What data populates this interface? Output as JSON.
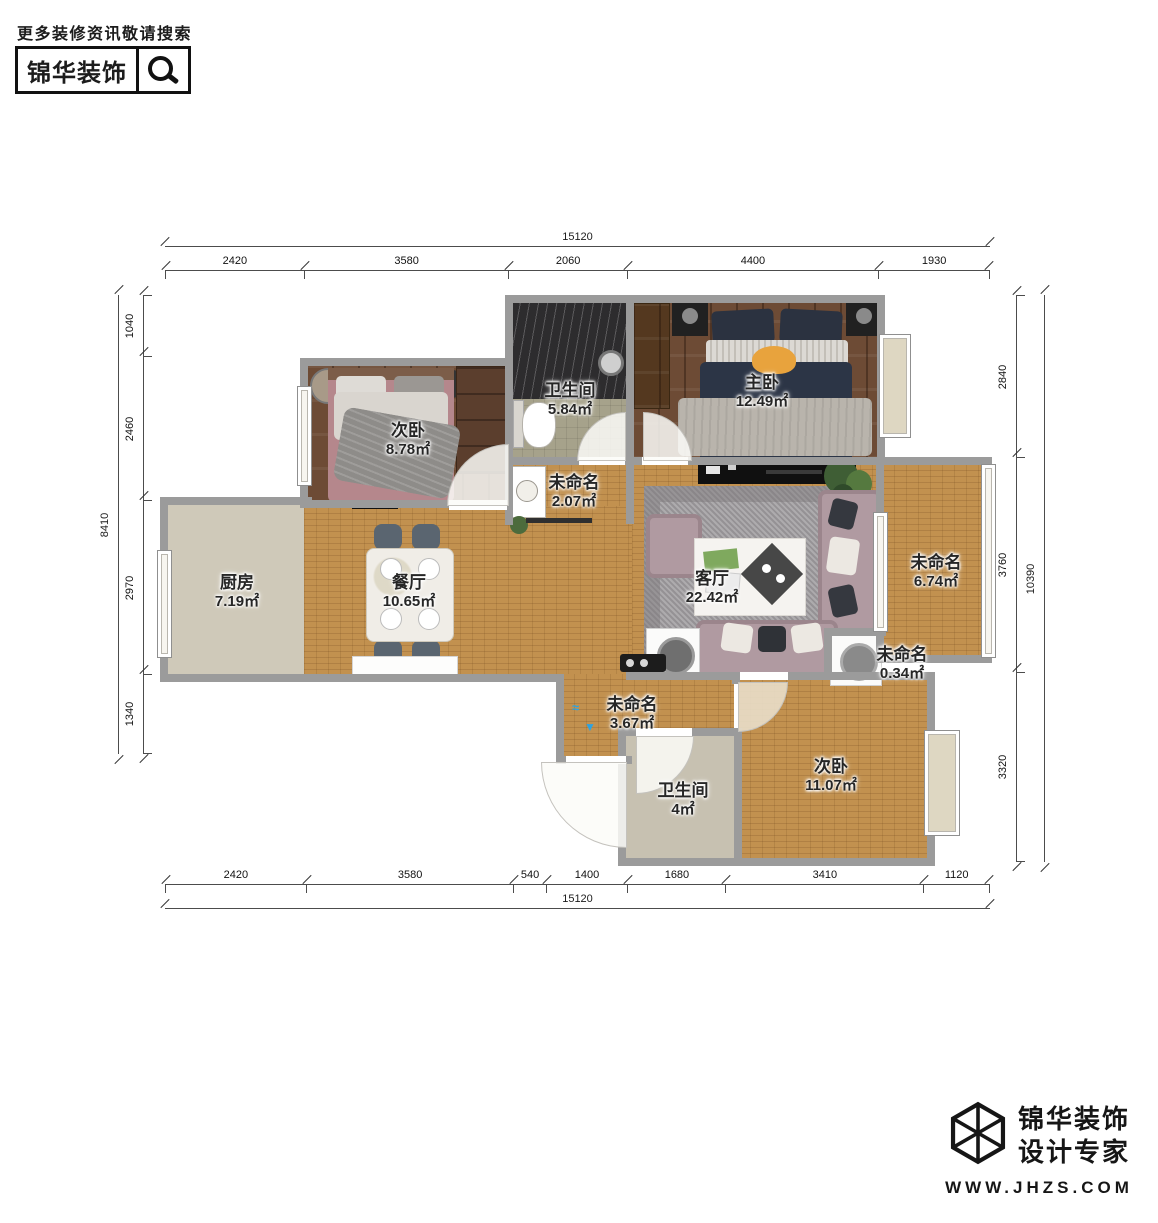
{
  "header": {
    "tagline": "更多装修资讯敬请搜索",
    "brand": "锦华装饰"
  },
  "footer": {
    "brand_line1": "锦华装饰",
    "brand_line2": "设计专家",
    "website": "WWW.JHZS.COM"
  },
  "rooms": [
    {
      "name": "卫生间",
      "area": "5.84㎡"
    },
    {
      "name": "主卧",
      "area": "12.49㎡"
    },
    {
      "name": "次卧",
      "area": "8.78㎡"
    },
    {
      "name": "未命名",
      "area": "2.07㎡"
    },
    {
      "name": "厨房",
      "area": "7.19㎡"
    },
    {
      "name": "餐厅",
      "area": "10.65㎡"
    },
    {
      "name": "客厅",
      "area": "22.42㎡"
    },
    {
      "name": "未命名",
      "area": "6.74㎡"
    },
    {
      "name": "未命名",
      "area": "0.34㎡"
    },
    {
      "name": "未命名",
      "area": "3.67㎡"
    },
    {
      "name": "卫生间",
      "area": "4㎡"
    },
    {
      "name": "次卧",
      "area": "11.07㎡"
    }
  ],
  "dimensions": {
    "top": {
      "total": "15120",
      "segments": [
        2420,
        3580,
        2060,
        4400,
        1930
      ]
    },
    "bottom": {
      "total": "15120",
      "segments": [
        2420,
        3580,
        540,
        1400,
        1680,
        3410,
        1120
      ]
    },
    "left": {
      "total": "8410",
      "segments": [
        1040,
        2460,
        2970,
        1340
      ]
    },
    "right": {
      "total": "10390",
      "segments": [
        2840,
        3760,
        3320
      ]
    }
  },
  "colors": {
    "wall": "#9b9b9b",
    "wood_light": "#c2914f",
    "wood_dark": "#6d4b35",
    "tile_beige": "#cfc9b9",
    "brand_black": "#111111",
    "marker_blue": "#2ea3e0"
  }
}
